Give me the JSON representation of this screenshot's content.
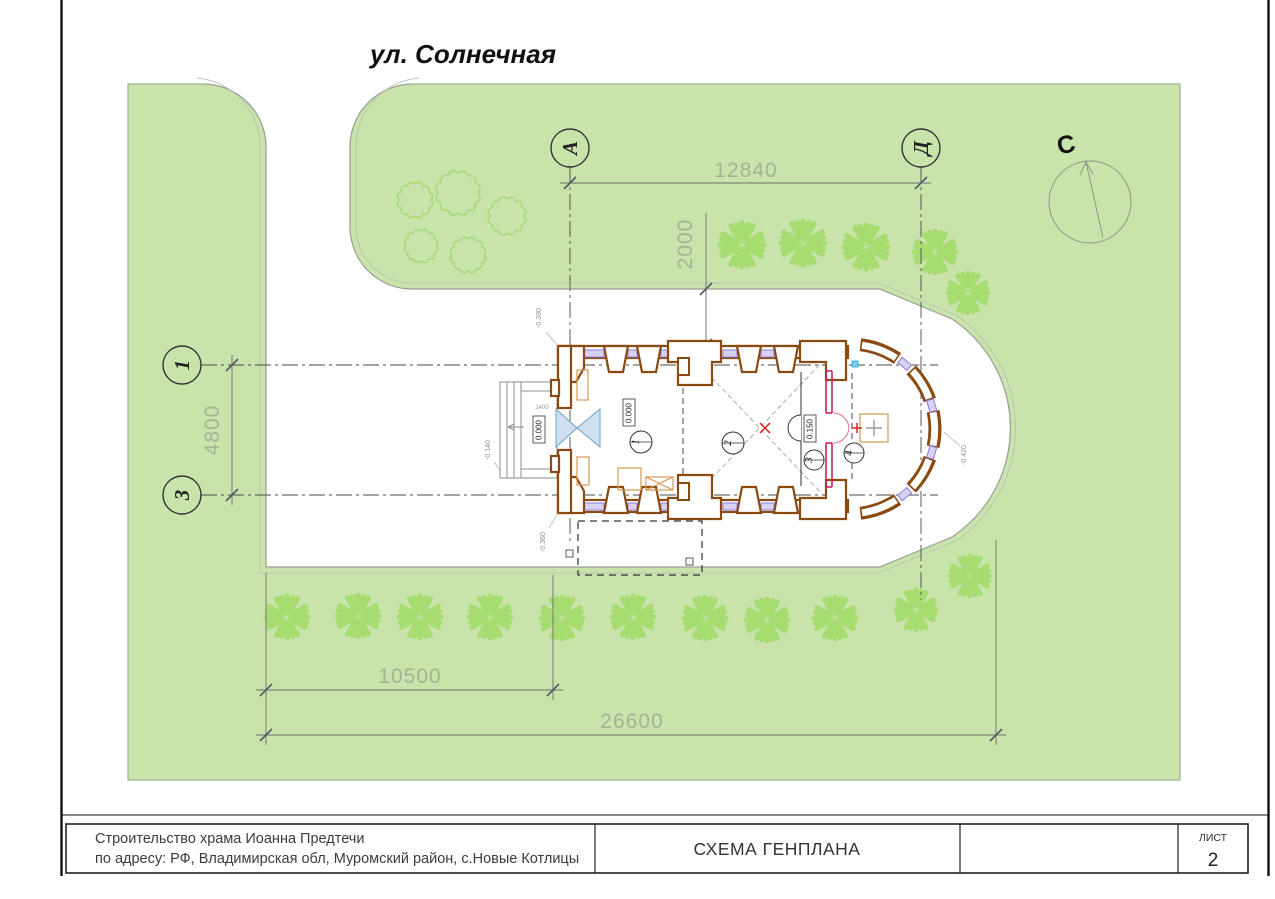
{
  "street": {
    "label": "ул. Солнечная"
  },
  "north": {
    "label": "С"
  },
  "axis_markers": {
    "a": "А",
    "d": "Д",
    "one": "1",
    "three": "3"
  },
  "dims": {
    "top": "12840",
    "offset": "2000",
    "left": "4800",
    "bottom_inner": "10500",
    "bottom_outer": "26600",
    "porch": "1400"
  },
  "levels": {
    "zero_hall": "0.000",
    "zero_porch": "0.000",
    "solea": "0.150",
    "corner_ne": "-0.390",
    "porch_low": "-0.140",
    "corner_se": "-0.360",
    "apse_low": "-0.420"
  },
  "rooms": {
    "r1": "1",
    "r2": "2",
    "r3": "3",
    "r4": "4"
  },
  "title_block": {
    "line1": "Строительство храма Иоанна Предтечи",
    "line2": "по адресу: РФ, Владимирская обл, Муромский район, с.Новые Котлицы",
    "drawing_title": "СХЕМА ГЕНПЛАНА",
    "sheet_label": "ЛИСТ",
    "sheet_number": "2"
  },
  "colors": {
    "site_green": "#c9e4ab",
    "plant_green": "#a6dc70",
    "wall_brown": "#8a4a12",
    "window_purple": "#8f7ce0",
    "iconostasis_crimson": "#cc2266",
    "accent_red": "#e02020"
  }
}
